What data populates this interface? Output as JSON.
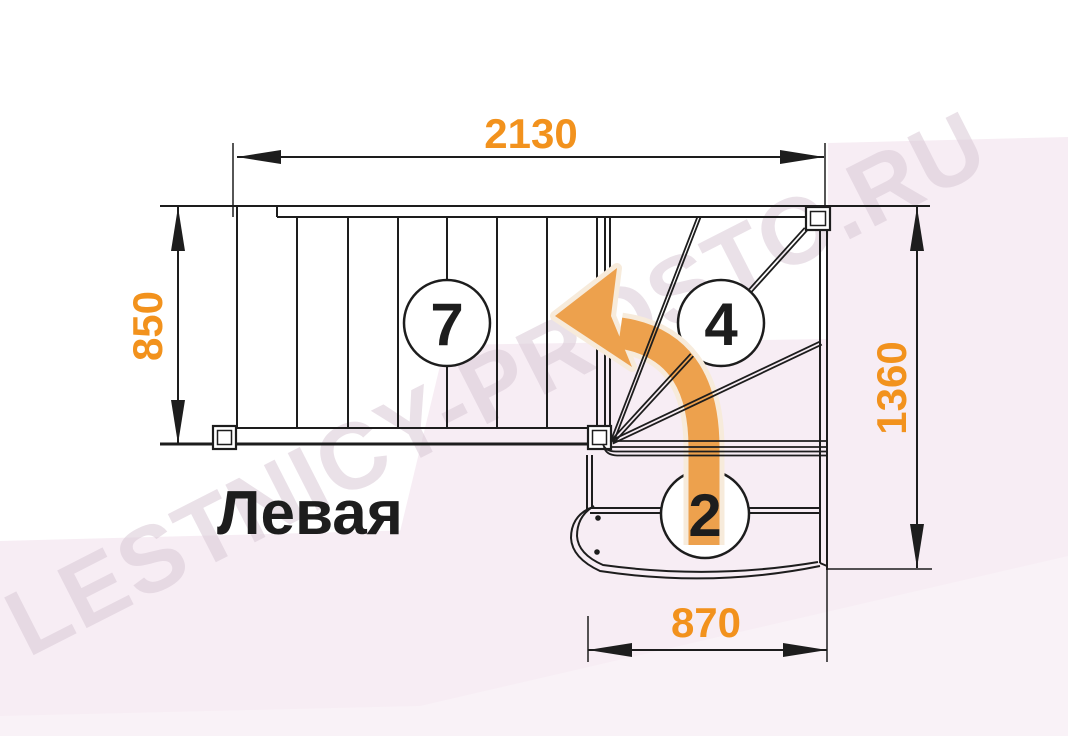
{
  "title": "Левая",
  "watermark": "LESTNICY-PROSTO.RU",
  "dimensions": {
    "top": "2130",
    "left": "850",
    "right": "1360",
    "bottom": "870"
  },
  "step_counts": {
    "upper_flight": "7",
    "winders": "4",
    "lower_flight": "2"
  },
  "colors": {
    "dimension_text": "#F2921D",
    "arrow": "#EDA14D",
    "arrow_halo": "#F7EBDB",
    "line": "#1D1D1D",
    "background_tint": "#F7EDF4",
    "watermark": "#D9C9D6"
  }
}
